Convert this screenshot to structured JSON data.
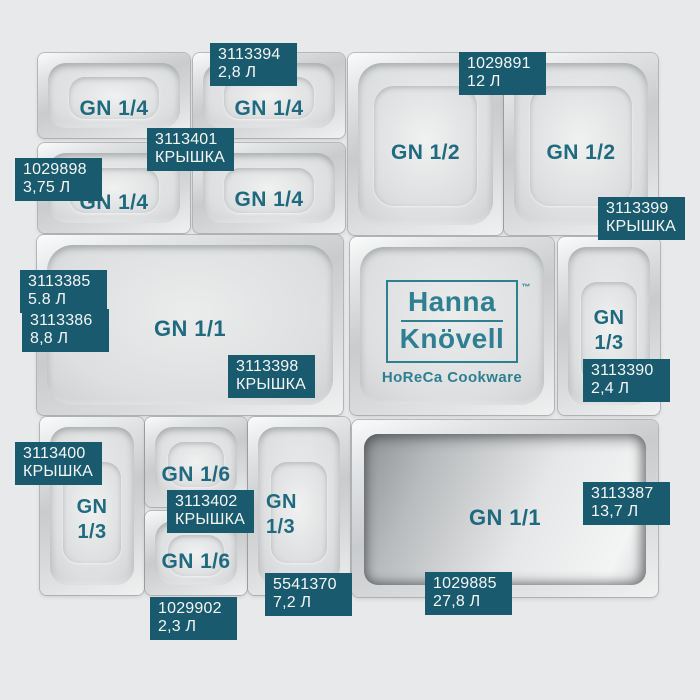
{
  "colors": {
    "background": "#e8e9ea",
    "tag_bg": "#195a6e",
    "tag_text": "#f4f7f8",
    "gn_text": "#206a80",
    "logo_teal": "#2f7f92"
  },
  "brand": {
    "line1": "Hanna",
    "line2": "Knövell",
    "tm": "™",
    "tagline": "HoReCa Cookware"
  },
  "pans": [
    {
      "size": "GN 1/4"
    },
    {
      "size": "GN 1/4"
    },
    {
      "size": "GN 1/4"
    },
    {
      "size": "GN 1/4"
    },
    {
      "size": "GN 1/2"
    },
    {
      "size": "GN 1/2"
    },
    {
      "size": "GN 1/1"
    },
    {
      "size_top": "GN",
      "size_bottom": "1/3"
    },
    {
      "size_top": "GN",
      "size_bottom": "1/3"
    },
    {
      "size": "GN 1/6"
    },
    {
      "size": "GN 1/6"
    },
    {
      "size_top": "GN",
      "size_bottom": "1/3"
    },
    {
      "size": "GN 1/1"
    }
  ],
  "tags": [
    {
      "sku": "3113394",
      "info": "2,8 Л"
    },
    {
      "sku": "3113401",
      "info": "КРЫШКА"
    },
    {
      "sku": "1029898",
      "info": "3,75 Л"
    },
    {
      "sku": "1029891",
      "info": "12 Л"
    },
    {
      "sku": "3113399",
      "info": "КРЫШКА"
    },
    {
      "sku": "3113385",
      "info": "5.8 Л"
    },
    {
      "sku": "3113386",
      "info": "8,8 Л"
    },
    {
      "sku": "3113398",
      "info": "КРЫШКА"
    },
    {
      "sku": "3113390",
      "info": "2,4 Л"
    },
    {
      "sku": "3113400",
      "info": "КРЫШКА"
    },
    {
      "sku": "3113402",
      "info": "КРЫШКА"
    },
    {
      "sku": "1029902",
      "info": "2,3 Л"
    },
    {
      "sku": "5541370",
      "info": "7,2 Л"
    },
    {
      "sku": "3113387",
      "info": "13,7 Л"
    },
    {
      "sku": "1029885",
      "info": "27,8 Л"
    }
  ]
}
